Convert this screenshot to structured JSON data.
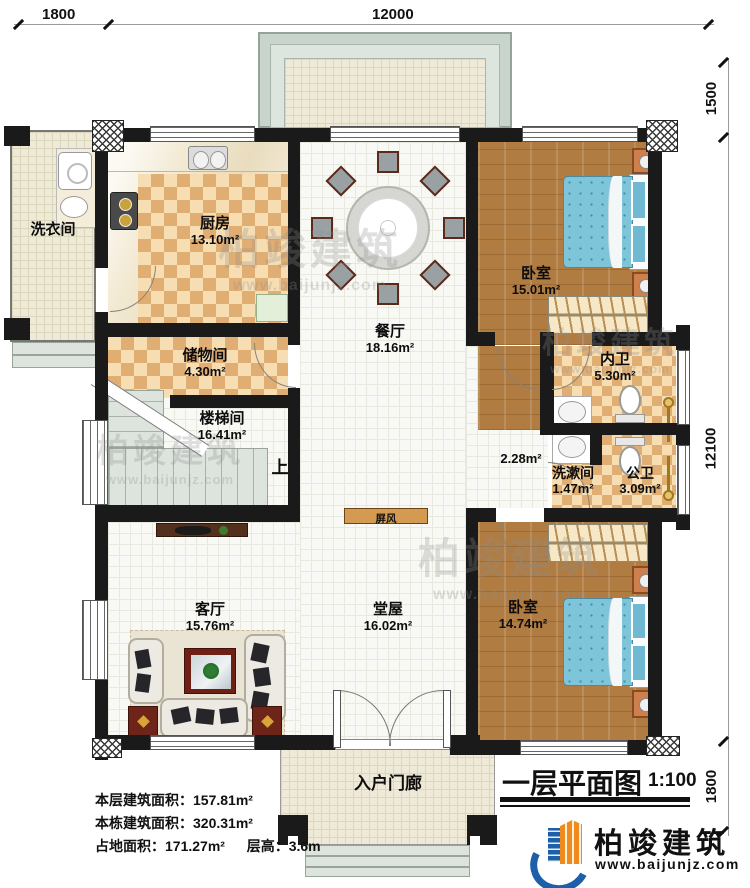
{
  "dimensions": {
    "top_left": "1800",
    "top_main": "12000",
    "right_top": "1500",
    "right_main": "12100",
    "right_bottom": "1800"
  },
  "rooms": {
    "laundry": {
      "name": "洗衣间"
    },
    "kitchen": {
      "name": "厨房",
      "area": "13.10m²"
    },
    "storage": {
      "name": "储物间",
      "area": "4.30m²"
    },
    "stairwell": {
      "name": "楼梯间",
      "area": "16.41m²"
    },
    "dining": {
      "name": "餐厅",
      "area": "18.16m²"
    },
    "bedroom_top": {
      "name": "卧室",
      "area": "15.01m²"
    },
    "ensuite": {
      "name": "内卫",
      "area": "5.30m²"
    },
    "corridor": {
      "area": "2.28m²"
    },
    "washroom": {
      "name": "洗漱间",
      "area": "1.47m²"
    },
    "public_bath": {
      "name": "公卫",
      "area": "3.09m²"
    },
    "living": {
      "name": "客厅",
      "area": "15.76m²"
    },
    "hall": {
      "name": "堂屋",
      "area": "16.02m²"
    },
    "bedroom_bottom": {
      "name": "卧室",
      "area": "14.74m²"
    },
    "entry_porch": {
      "name": "入户门廊"
    }
  },
  "annotations": {
    "screen": "屏风",
    "stairs_up": "上"
  },
  "info": {
    "lines": [
      {
        "label": "本层建筑面积：",
        "value": "157.81m²"
      },
      {
        "label": "本栋建筑面积：",
        "value": "320.31m²"
      },
      {
        "label": "占地面积：",
        "value": "171.27m²",
        "label2": "层高：",
        "value2": "3.6m"
      }
    ]
  },
  "title_block": {
    "title": "一层平面图",
    "scale": "1:100"
  },
  "brand": {
    "name": "柏竣建筑",
    "url": "www.baijunjz.com"
  },
  "watermark": {
    "name": "柏竣建筑",
    "url": "www.baijunjz.com"
  },
  "colors": {
    "wall": "#1a1a1a",
    "tile_orange": "#e0ad73",
    "wood": "#b07c42",
    "bed_blue": "#7fc5da",
    "screen_tan": "#d59a52",
    "brand_blue": "#1d5fa8",
    "brand_orange": "#ef8b1d"
  }
}
